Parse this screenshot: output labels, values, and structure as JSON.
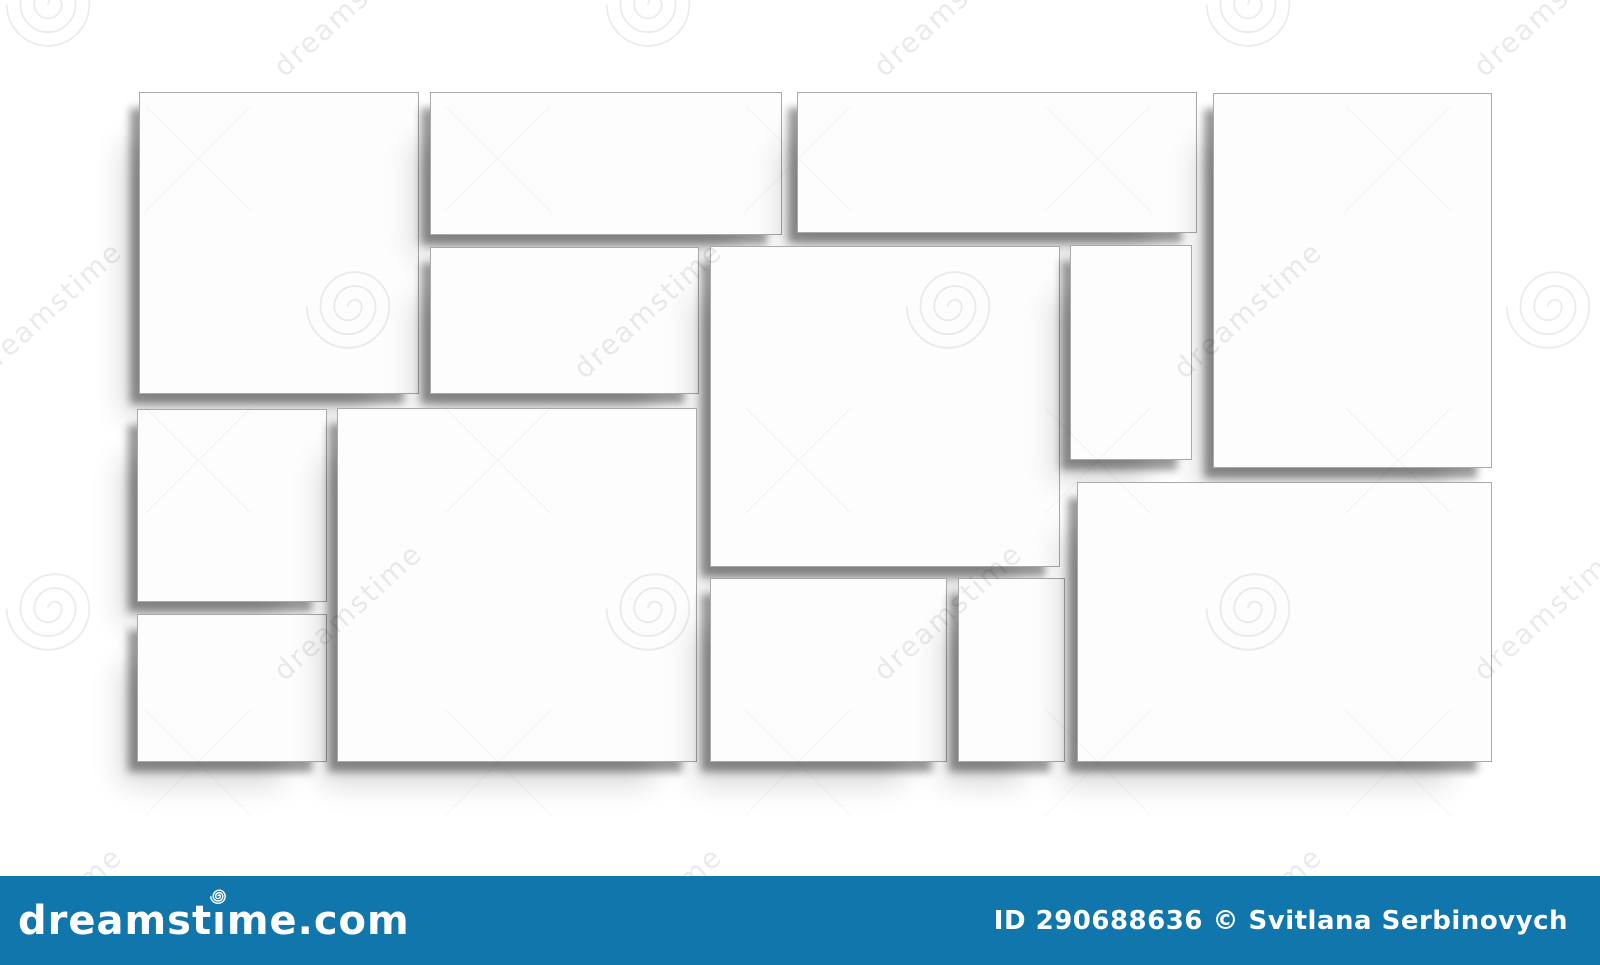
{
  "page": {
    "width": 1600,
    "height": 965,
    "background": "#ffffff"
  },
  "watermark": {
    "text": "dreamstime"
  },
  "collage": {
    "tile_color": "#fdfdfd",
    "tile_border_color": "#a9a9a9",
    "frames": [
      {
        "name": "frame-1",
        "x": 139,
        "y": 92,
        "w": 280,
        "h": 302
      },
      {
        "name": "frame-2",
        "x": 430,
        "y": 92,
        "w": 352,
        "h": 143
      },
      {
        "name": "frame-3",
        "x": 797,
        "y": 92,
        "w": 400,
        "h": 141
      },
      {
        "name": "frame-4",
        "x": 1213,
        "y": 93,
        "w": 279,
        "h": 375
      },
      {
        "name": "frame-5",
        "x": 430,
        "y": 247,
        "w": 269,
        "h": 147
      },
      {
        "name": "frame-6",
        "x": 710,
        "y": 246,
        "w": 350,
        "h": 321
      },
      {
        "name": "frame-7",
        "x": 1070,
        "y": 245,
        "w": 122,
        "h": 215
      },
      {
        "name": "frame-8",
        "x": 137,
        "y": 409,
        "w": 190,
        "h": 193
      },
      {
        "name": "frame-9",
        "x": 137,
        "y": 614,
        "w": 190,
        "h": 148
      },
      {
        "name": "frame-10",
        "x": 337,
        "y": 408,
        "w": 360,
        "h": 354
      },
      {
        "name": "frame-11",
        "x": 710,
        "y": 578,
        "w": 237,
        "h": 184
      },
      {
        "name": "frame-12",
        "x": 958,
        "y": 578,
        "w": 107,
        "h": 184
      },
      {
        "name": "frame-13",
        "x": 1077,
        "y": 482,
        "w": 415,
        "h": 280
      }
    ]
  },
  "footer": {
    "bar_color": "#1176ac",
    "text_color": "#ffffff",
    "logo": {
      "text_before_i": "dreamst",
      "text_i": "ı",
      "text_after": "me.com"
    },
    "credit_text": "ID 290688636 © Svitlana Serbinovych"
  }
}
